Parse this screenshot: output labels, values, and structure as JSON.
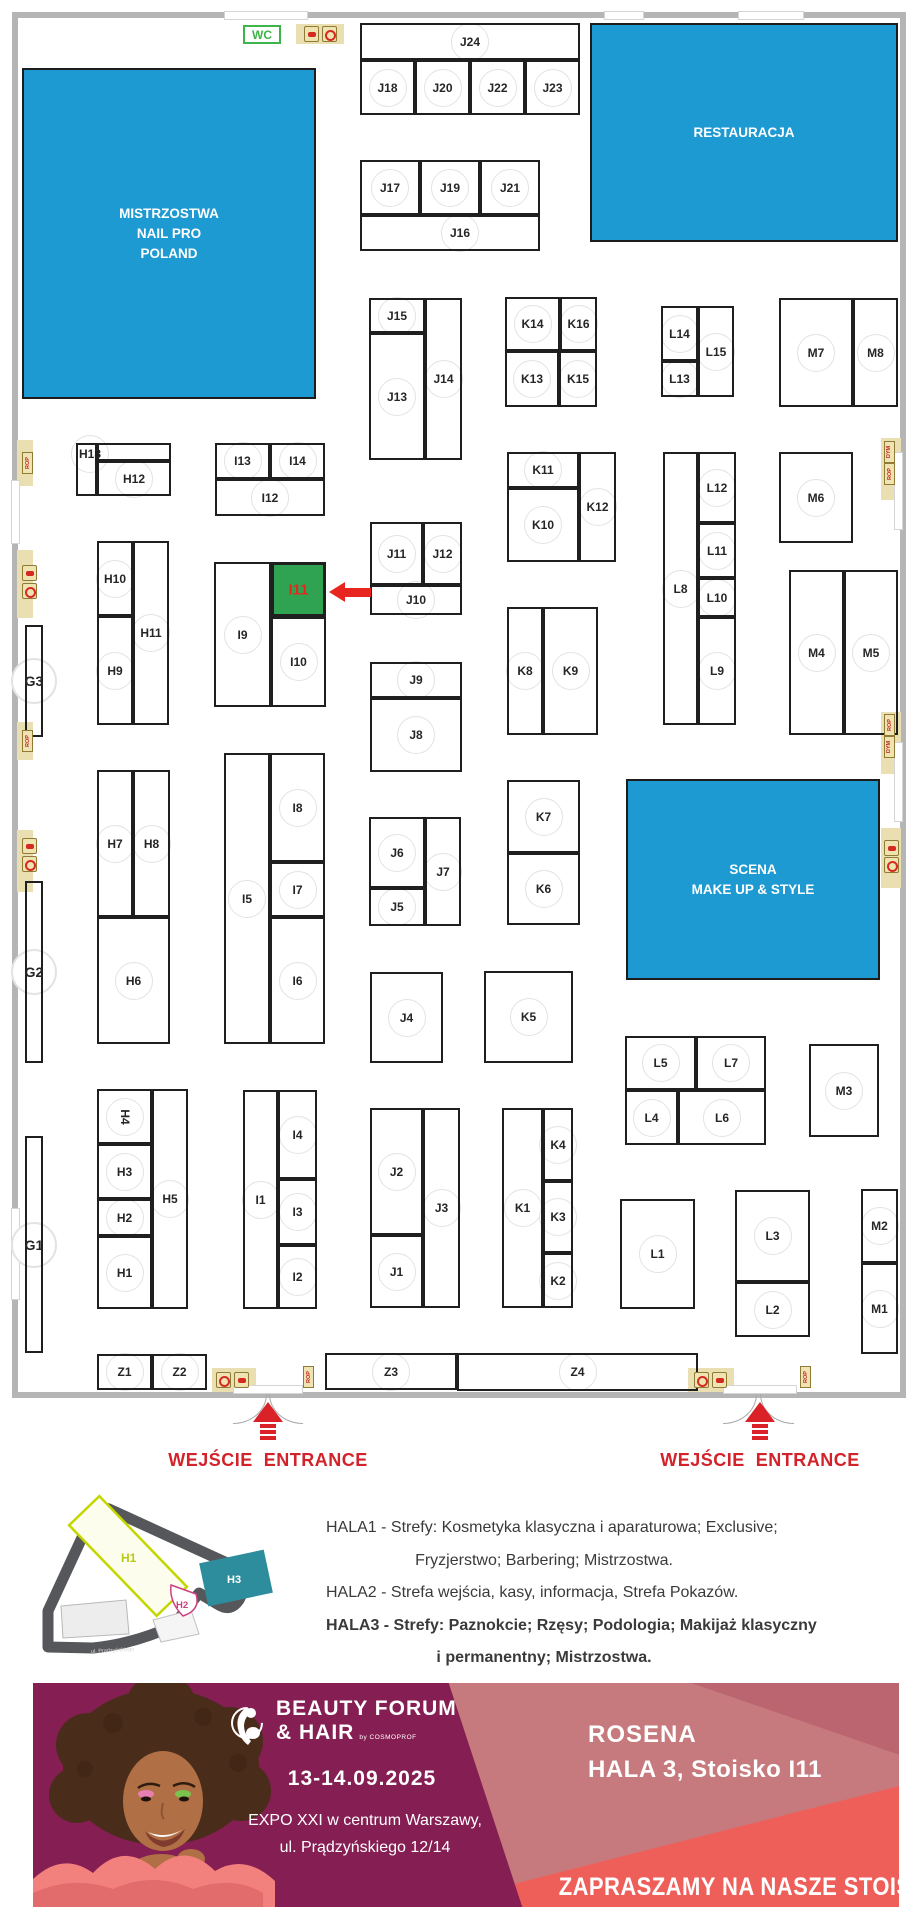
{
  "floorplan": {
    "wc_label": "WC",
    "area_color": "#1e9ad2",
    "highlight_booth": "I11",
    "highlight_color": "#2fa352",
    "highlight_text_color": "#e8251f",
    "areas": [
      {
        "id": "mistrzostwa",
        "lines": [
          "MISTRZOSTWA",
          "NAIL PRO",
          "POLAND"
        ],
        "x": 22,
        "y": 68,
        "w": 294,
        "h": 331
      },
      {
        "id": "restauracja",
        "lines": [
          "RESTAURACJA"
        ],
        "x": 590,
        "y": 23,
        "w": 308,
        "h": 219
      },
      {
        "id": "scena",
        "lines": [
          "SCENA",
          "MAKE UP & STYLE"
        ],
        "x": 626,
        "y": 779,
        "w": 254,
        "h": 201
      }
    ],
    "booths": [
      {
        "id": "J24",
        "x": 360,
        "y": 23,
        "w": 220,
        "h": 37
      },
      {
        "id": "J18",
        "x": 360,
        "y": 60,
        "w": 55,
        "h": 55
      },
      {
        "id": "J20",
        "x": 415,
        "y": 60,
        "w": 55,
        "h": 55
      },
      {
        "id": "J22",
        "x": 470,
        "y": 60,
        "w": 55,
        "h": 55
      },
      {
        "id": "J23",
        "x": 525,
        "y": 60,
        "w": 55,
        "h": 55
      },
      {
        "id": "J17",
        "x": 360,
        "y": 160,
        "w": 60,
        "h": 55
      },
      {
        "id": "J19",
        "x": 420,
        "y": 160,
        "w": 60,
        "h": 55
      },
      {
        "id": "J21",
        "x": 480,
        "y": 160,
        "w": 60,
        "h": 55
      },
      {
        "id": "J16",
        "x": 360,
        "y": 215,
        "w": 180,
        "h": 36,
        "lx": 460
      },
      {
        "id": "J15",
        "x": 369,
        "y": 298,
        "w": 56,
        "h": 35
      },
      {
        "id": "J13",
        "x": 369,
        "y": 333,
        "w": 56,
        "h": 127
      },
      {
        "id": "J14",
        "x": 425,
        "y": 298,
        "w": 37,
        "h": 162
      },
      {
        "id": "K14",
        "x": 505,
        "y": 297,
        "w": 55,
        "h": 54
      },
      {
        "id": "K16",
        "x": 560,
        "y": 297,
        "w": 37,
        "h": 54
      },
      {
        "id": "K13",
        "x": 505,
        "y": 351,
        "w": 54,
        "h": 56
      },
      {
        "id": "K15",
        "x": 559,
        "y": 351,
        "w": 38,
        "h": 56
      },
      {
        "id": "L14",
        "x": 661,
        "y": 306,
        "w": 37,
        "h": 55
      },
      {
        "id": "L13",
        "x": 661,
        "y": 361,
        "w": 37,
        "h": 36
      },
      {
        "id": "L15",
        "x": 698,
        "y": 306,
        "w": 36,
        "h": 91
      },
      {
        "id": "M7",
        "x": 779,
        "y": 298,
        "w": 74,
        "h": 109
      },
      {
        "id": "M8",
        "x": 853,
        "y": 298,
        "w": 45,
        "h": 109
      },
      {
        "id": "H13",
        "x": 76,
        "y": 443,
        "w": 21,
        "h": 53,
        "lx": 90,
        "ly": 454
      },
      {
        "id": "",
        "x": 97,
        "y": 443,
        "w": 74,
        "h": 18
      },
      {
        "id": "H12",
        "x": 97,
        "y": 461,
        "w": 74,
        "h": 35
      },
      {
        "id": "I13",
        "x": 215,
        "y": 443,
        "w": 55,
        "h": 36
      },
      {
        "id": "I14",
        "x": 270,
        "y": 443,
        "w": 55,
        "h": 36
      },
      {
        "id": "I12",
        "x": 215,
        "y": 479,
        "w": 110,
        "h": 37
      },
      {
        "id": "K11",
        "x": 507,
        "y": 452,
        "w": 72,
        "h": 36
      },
      {
        "id": "K10",
        "x": 507,
        "y": 488,
        "w": 72,
        "h": 74
      },
      {
        "id": "K12",
        "x": 579,
        "y": 452,
        "w": 37,
        "h": 110
      },
      {
        "id": "L8",
        "x": 663,
        "y": 452,
        "w": 35,
        "h": 273
      },
      {
        "id": "L12",
        "x": 698,
        "y": 452,
        "w": 38,
        "h": 71
      },
      {
        "id": "L11",
        "x": 698,
        "y": 523,
        "w": 38,
        "h": 55
      },
      {
        "id": "L10",
        "x": 698,
        "y": 578,
        "w": 38,
        "h": 39
      },
      {
        "id": "L9",
        "x": 698,
        "y": 617,
        "w": 38,
        "h": 108
      },
      {
        "id": "M6",
        "x": 779,
        "y": 452,
        "w": 74,
        "h": 91
      },
      {
        "id": "H10",
        "x": 97,
        "y": 541,
        "w": 36,
        "h": 75
      },
      {
        "id": "H9",
        "x": 97,
        "y": 616,
        "w": 36,
        "h": 109
      },
      {
        "id": "H11",
        "x": 133,
        "y": 541,
        "w": 36,
        "h": 184
      },
      {
        "id": "I9",
        "x": 214,
        "y": 562,
        "w": 57,
        "h": 145
      },
      {
        "id": "I11",
        "x": 271,
        "y": 562,
        "w": 55,
        "h": 55
      },
      {
        "id": "I10",
        "x": 271,
        "y": 617,
        "w": 55,
        "h": 90
      },
      {
        "id": "J11",
        "x": 370,
        "y": 522,
        "w": 53,
        "h": 63
      },
      {
        "id": "J12",
        "x": 423,
        "y": 522,
        "w": 39,
        "h": 63
      },
      {
        "id": "J10",
        "x": 370,
        "y": 585,
        "w": 92,
        "h": 30
      },
      {
        "id": "G3",
        "x": 25,
        "y": 625,
        "w": 18,
        "h": 112,
        "big": true
      },
      {
        "id": "J9",
        "x": 370,
        "y": 662,
        "w": 92,
        "h": 36
      },
      {
        "id": "J8",
        "x": 370,
        "y": 698,
        "w": 92,
        "h": 74
      },
      {
        "id": "K8",
        "x": 507,
        "y": 607,
        "w": 36,
        "h": 128
      },
      {
        "id": "K9",
        "x": 543,
        "y": 607,
        "w": 55,
        "h": 128
      },
      {
        "id": "M4",
        "x": 789,
        "y": 570,
        "w": 55,
        "h": 165
      },
      {
        "id": "M5",
        "x": 844,
        "y": 570,
        "w": 54,
        "h": 165
      },
      {
        "id": "I5",
        "x": 224,
        "y": 753,
        "w": 46,
        "h": 291
      },
      {
        "id": "I8",
        "x": 270,
        "y": 753,
        "w": 55,
        "h": 109
      },
      {
        "id": "I7",
        "x": 270,
        "y": 862,
        "w": 55,
        "h": 55
      },
      {
        "id": "I6",
        "x": 270,
        "y": 917,
        "w": 55,
        "h": 127
      },
      {
        "id": "H7",
        "x": 97,
        "y": 770,
        "w": 36,
        "h": 147
      },
      {
        "id": "H8",
        "x": 133,
        "y": 770,
        "w": 37,
        "h": 147
      },
      {
        "id": "H6",
        "x": 97,
        "y": 917,
        "w": 73,
        "h": 127
      },
      {
        "id": "J6",
        "x": 369,
        "y": 817,
        "w": 56,
        "h": 71
      },
      {
        "id": "J5",
        "x": 369,
        "y": 888,
        "w": 56,
        "h": 38
      },
      {
        "id": "J7",
        "x": 425,
        "y": 817,
        "w": 36,
        "h": 109
      },
      {
        "id": "K7",
        "x": 507,
        "y": 780,
        "w": 73,
        "h": 73
      },
      {
        "id": "K6",
        "x": 507,
        "y": 853,
        "w": 73,
        "h": 72
      },
      {
        "id": "G2",
        "x": 25,
        "y": 881,
        "w": 18,
        "h": 182,
        "big": true
      },
      {
        "id": "J4",
        "x": 370,
        "y": 972,
        "w": 73,
        "h": 91
      },
      {
        "id": "K5",
        "x": 484,
        "y": 971,
        "w": 89,
        "h": 92
      },
      {
        "id": "L5",
        "x": 625,
        "y": 1036,
        "w": 71,
        "h": 54
      },
      {
        "id": "L7",
        "x": 696,
        "y": 1036,
        "w": 70,
        "h": 54
      },
      {
        "id": "L4",
        "x": 625,
        "y": 1090,
        "w": 53,
        "h": 55
      },
      {
        "id": "L6",
        "x": 678,
        "y": 1090,
        "w": 88,
        "h": 55
      },
      {
        "id": "M3",
        "x": 809,
        "y": 1044,
        "w": 70,
        "h": 93
      },
      {
        "id": "H4",
        "x": 97,
        "y": 1089,
        "w": 55,
        "h": 55,
        "rot": true
      },
      {
        "id": "H3",
        "x": 97,
        "y": 1144,
        "w": 55,
        "h": 55
      },
      {
        "id": "H2",
        "x": 97,
        "y": 1199,
        "w": 55,
        "h": 37
      },
      {
        "id": "H1",
        "x": 97,
        "y": 1236,
        "w": 55,
        "h": 73
      },
      {
        "id": "H5",
        "x": 152,
        "y": 1089,
        "w": 36,
        "h": 220
      },
      {
        "id": "I1",
        "x": 243,
        "y": 1090,
        "w": 35,
        "h": 219
      },
      {
        "id": "I4",
        "x": 278,
        "y": 1090,
        "w": 39,
        "h": 89
      },
      {
        "id": "I3",
        "x": 278,
        "y": 1179,
        "w": 39,
        "h": 66
      },
      {
        "id": "I2",
        "x": 278,
        "y": 1245,
        "w": 39,
        "h": 64
      },
      {
        "id": "J2",
        "x": 370,
        "y": 1108,
        "w": 53,
        "h": 127
      },
      {
        "id": "J1",
        "x": 370,
        "y": 1235,
        "w": 53,
        "h": 73
      },
      {
        "id": "J3",
        "x": 423,
        "y": 1108,
        "w": 37,
        "h": 200
      },
      {
        "id": "K1",
        "x": 502,
        "y": 1108,
        "w": 41,
        "h": 200
      },
      {
        "id": "K4",
        "x": 543,
        "y": 1108,
        "w": 30,
        "h": 73
      },
      {
        "id": "K3",
        "x": 543,
        "y": 1181,
        "w": 30,
        "h": 72
      },
      {
        "id": "K2",
        "x": 543,
        "y": 1253,
        "w": 30,
        "h": 55
      },
      {
        "id": "L1",
        "x": 620,
        "y": 1199,
        "w": 75,
        "h": 110
      },
      {
        "id": "L3",
        "x": 735,
        "y": 1190,
        "w": 75,
        "h": 92
      },
      {
        "id": "L2",
        "x": 735,
        "y": 1282,
        "w": 75,
        "h": 55
      },
      {
        "id": "M2",
        "x": 861,
        "y": 1189,
        "w": 37,
        "h": 74
      },
      {
        "id": "M1",
        "x": 861,
        "y": 1263,
        "w": 37,
        "h": 91
      },
      {
        "id": "G1",
        "x": 25,
        "y": 1136,
        "w": 18,
        "h": 217,
        "big": true
      },
      {
        "id": "Z1",
        "x": 97,
        "y": 1354,
        "w": 55,
        "h": 36
      },
      {
        "id": "Z2",
        "x": 152,
        "y": 1354,
        "w": 55,
        "h": 36
      },
      {
        "id": "Z3",
        "x": 325,
        "y": 1353,
        "w": 132,
        "h": 37
      },
      {
        "id": "Z4",
        "x": 457,
        "y": 1353,
        "w": 241,
        "h": 38
      }
    ],
    "pads": [
      [
        296,
        24,
        48,
        20
      ],
      [
        17,
        440,
        16,
        46
      ],
      [
        17,
        550,
        16,
        68
      ],
      [
        17,
        722,
        16,
        38
      ],
      [
        17,
        830,
        16,
        62
      ],
      [
        881,
        438,
        20,
        62
      ],
      [
        881,
        712,
        20,
        62
      ],
      [
        881,
        828,
        20,
        60
      ],
      [
        212,
        1368,
        44,
        24
      ],
      [
        688,
        1368,
        46,
        24
      ]
    ],
    "doors": [
      [
        224,
        11,
        84,
        9
      ],
      [
        604,
        11,
        40,
        9
      ],
      [
        738,
        11,
        66,
        9
      ],
      [
        11,
        480,
        9,
        64
      ],
      [
        11,
        1208,
        9,
        92
      ],
      [
        894,
        452,
        9,
        78
      ],
      [
        894,
        742,
        9,
        80
      ],
      [
        233,
        1385,
        70,
        9
      ],
      [
        723,
        1385,
        74,
        9
      ]
    ],
    "arcs": [
      [
        233,
        1394,
        "l"
      ],
      [
        269,
        1394,
        "r"
      ],
      [
        723,
        1394,
        "l"
      ],
      [
        760,
        1394,
        "r"
      ]
    ],
    "icons": [
      {
        "t": "ext",
        "x": 304,
        "y": 26
      },
      {
        "t": "hose",
        "x": 322,
        "y": 26
      },
      {
        "t": "rop",
        "x": 22,
        "y": 452
      },
      {
        "t": "ext",
        "x": 22,
        "y": 565
      },
      {
        "t": "hose",
        "x": 22,
        "y": 583
      },
      {
        "t": "rop",
        "x": 22,
        "y": 730
      },
      {
        "t": "ext",
        "x": 22,
        "y": 838
      },
      {
        "t": "hose",
        "x": 22,
        "y": 856
      },
      {
        "t": "dym",
        "x": 884,
        "y": 441
      },
      {
        "t": "rop",
        "x": 884,
        "y": 463
      },
      {
        "t": "rop",
        "x": 884,
        "y": 714
      },
      {
        "t": "dym",
        "x": 884,
        "y": 736
      },
      {
        "t": "ext",
        "x": 884,
        "y": 840
      },
      {
        "t": "hose",
        "x": 884,
        "y": 857
      },
      {
        "t": "hose",
        "x": 216,
        "y": 1372
      },
      {
        "t": "ext",
        "x": 234,
        "y": 1372
      },
      {
        "t": "rop",
        "x": 303,
        "y": 1366
      },
      {
        "t": "hose",
        "x": 694,
        "y": 1372
      },
      {
        "t": "ext",
        "x": 712,
        "y": 1372
      },
      {
        "t": "rop",
        "x": 800,
        "y": 1366
      }
    ],
    "entrances": [
      {
        "label": "WEJŚCIE  ENTRANCE",
        "cx": 268,
        "arrow_y": 1402,
        "label_y": 1450
      },
      {
        "label": "WEJŚCIE  ENTRANCE",
        "cx": 760,
        "arrow_y": 1402,
        "label_y": 1450
      }
    ]
  },
  "legend": {
    "lines": [
      {
        "text": "HALA1 - Strefy: Kosmetyka klasyczna i aparaturowa; Exclusive;",
        "bold": false,
        "align": "left"
      },
      {
        "text": "Fryzjerstwo; Barbering; Mistrzostwa.",
        "bold": false,
        "align": "center"
      },
      {
        "text": "HALA2 - Strefa wejścia, kasy, informacja, Strefa Pokazów.",
        "bold": false,
        "align": "left"
      },
      {
        "text": "HALA3 - Strefy: Paznokcie; Rzęsy; Podologia; Makijaż klasyczny",
        "bold": true,
        "align": "left"
      },
      {
        "text": "i permanentny; Mistrzostwa.",
        "bold": true,
        "align": "center"
      }
    ]
  },
  "minimap": {
    "h1": "H1",
    "h2": "H2",
    "h3": "H3",
    "street": "ul. Prądzyńskiego"
  },
  "banner": {
    "logo_line1": "BEAUTY FORUM",
    "logo_line2": "& HAIR",
    "logo_by": "by COSMOPROF",
    "date": "13-14.09.2025",
    "address_line1": "EXPO XXI w centrum Warszawy,",
    "address_line2": "ul. Prądzyńskiego 12/14",
    "exhibitor": "ROSENA",
    "location": "HALA 3, Stoisko I11",
    "cta": "ZAPRASZAMY NA NASZE STOISKO!",
    "colors": {
      "purple": "#851e52",
      "rose": "#c67a7d",
      "rose_dark": "#bb6570",
      "coral": "#ef5f5a"
    }
  }
}
